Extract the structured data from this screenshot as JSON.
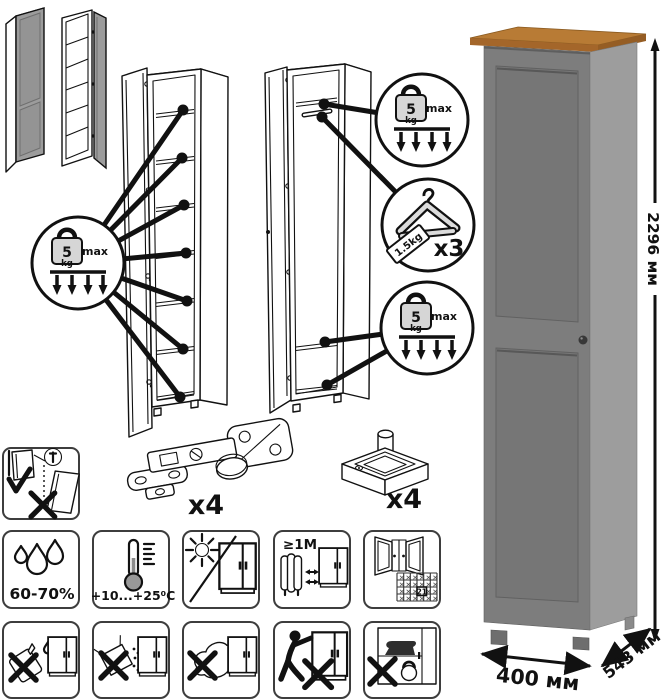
{
  "load_badge": {
    "value": "5",
    "unit": "kg",
    "qualifier": "max"
  },
  "hanger_badge": {
    "capacity": "1.5kg",
    "quantity": "x3"
  },
  "hardware": {
    "hinge_quantity": "x4",
    "foot_quantity": "x4"
  },
  "care": {
    "humidity_range": "60-70%",
    "temperature_range": "+10...+25⁰C",
    "min_heater_distance": "≥1М",
    "calendar_day": "21"
  },
  "dimensions": {
    "height": "2296 мм",
    "width": "400 мм",
    "depth": "543 мм"
  },
  "colors": {
    "wardrobe_front": "#7d7d7d",
    "wardrobe_side": "#9d9d9d",
    "door_panel": "#767676",
    "wood_top": "#b87b35",
    "door_knob": "#383838",
    "line_art": "#111111",
    "thumbnail_door": "#9c9c9c"
  }
}
